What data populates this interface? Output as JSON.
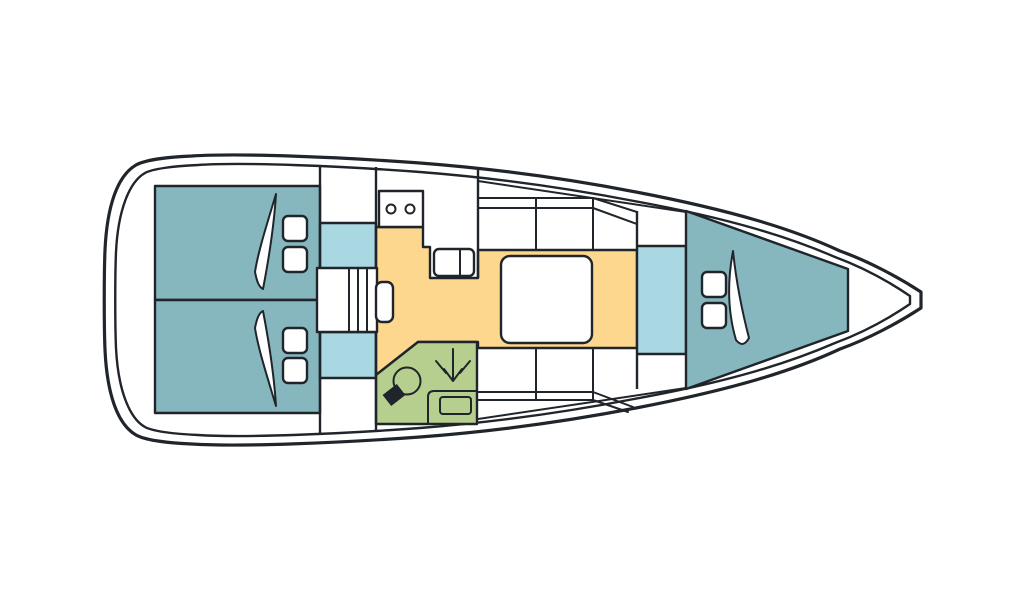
{
  "page": {
    "title": "Sailing yacht interior layout plan (top view, bow to the right)"
  },
  "colors": {
    "line": "#20252b",
    "cabin_teal": "#86b7bf",
    "passage_blue": "#a9d8e3",
    "saloon_yellow": "#fcd78d",
    "head_green": "#b7cf8e",
    "furniture_white": "#ffffff",
    "hull_fill": "#ffffff",
    "background": "#ffffff"
  },
  "diagram": {
    "type": "floor-plan",
    "subject": "monohull sailing yacht deck plan",
    "orientation": "bow-right",
    "rooms": [
      {
        "id": "aft-cabin-port",
        "semantic": "aft double cabin (top/port)",
        "color_key": "cabin_teal"
      },
      {
        "id": "aft-cabin-starboard",
        "semantic": "aft double cabin (bottom/starboard)",
        "color_key": "cabin_teal"
      },
      {
        "id": "passage-port",
        "semantic": "cabin entry area (port)",
        "color_key": "passage_blue"
      },
      {
        "id": "passage-starboard",
        "semantic": "cabin entry area (starboard)",
        "color_key": "passage_blue"
      },
      {
        "id": "galley",
        "semantic": "galley with two-burner stove and double sink",
        "color_key": "hull_fill"
      },
      {
        "id": "saloon",
        "semantic": "saloon floor with table and settees",
        "color_key": "saloon_yellow"
      },
      {
        "id": "head",
        "semantic": "head / wet room with toilet, basin, shower",
        "color_key": "head_green"
      },
      {
        "id": "corridor-fore",
        "semantic": "forward corridor",
        "color_key": "passage_blue"
      },
      {
        "id": "fore-cabin",
        "semantic": "forward V-berth cabin",
        "color_key": "cabin_teal"
      }
    ],
    "furniture": [
      {
        "id": "companionway-stairs",
        "semantic": "companionway steps"
      },
      {
        "id": "stove-icon",
        "semantic": "two-burner stove"
      },
      {
        "id": "galley-sink-icon",
        "semantic": "double sink"
      },
      {
        "id": "saloon-table",
        "semantic": "saloon table"
      },
      {
        "id": "settee-port",
        "semantic": "port settee"
      },
      {
        "id": "settee-starboard",
        "semantic": "starboard settee"
      },
      {
        "id": "toilet-icon",
        "semantic": "marine toilet"
      },
      {
        "id": "shower-icon",
        "semantic": "shower spray arrow"
      },
      {
        "id": "head-sink-icon",
        "semantic": "washbasin"
      },
      {
        "id": "pillow",
        "semantic": "berth pillow (six total)"
      },
      {
        "id": "blanket-icon",
        "semantic": "berth blanket / sail-shaped cushion marker (three total)"
      }
    ]
  }
}
